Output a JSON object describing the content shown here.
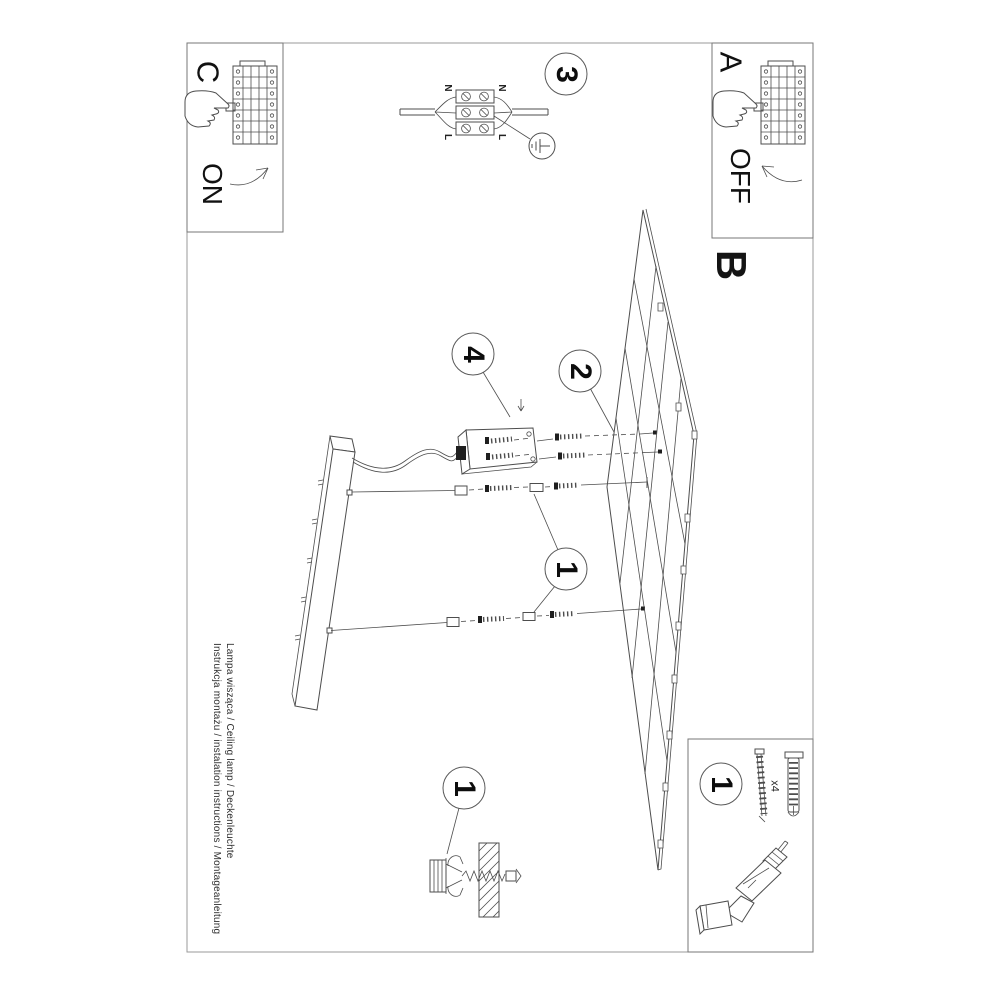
{
  "meta": {
    "background_color": "#ffffff",
    "ink_color": "#4d4d4d",
    "text_color": "#141414"
  },
  "instruction_footer": {
    "product_line": "Lampa wisząca / Ceiling lamp / Deckenleuchte",
    "title_line": "Instrukcja montażu / instalation instructions / Montageanleitung"
  },
  "steps": {
    "a": {
      "label": "A",
      "caption": "OFF"
    },
    "b": {
      "label": "B"
    },
    "c": {
      "label": "C",
      "caption": "ON"
    },
    "n1": "1",
    "n2": "2",
    "n3": "3",
    "n4": "4"
  },
  "wiring_diagram": {
    "neutral_label": "N",
    "live_label": "L"
  },
  "hardware": {
    "quantity_note": "x4"
  }
}
